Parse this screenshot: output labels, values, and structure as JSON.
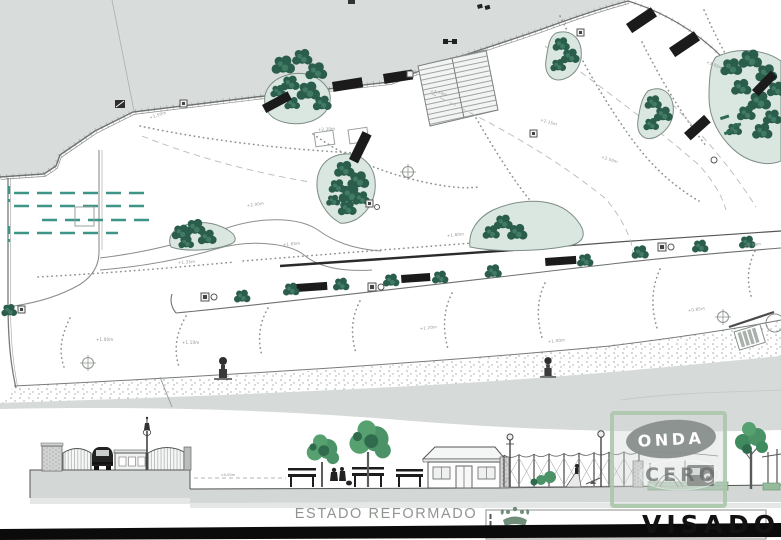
{
  "drawing": {
    "caption": "ESTADO REFORMADO",
    "stamp": {
      "title": "VISADO",
      "crest_icon": "crown-crest"
    },
    "watermark": {
      "line1": "ONDA",
      "line2": "CERO"
    },
    "section_label": "±0.00m",
    "spot_labels": [
      {
        "text": "+1.50m"
      },
      {
        "text": "+2.00m"
      },
      {
        "text": "+2.30m"
      },
      {
        "text": "+1.80m"
      },
      {
        "text": "+1.65m"
      },
      {
        "text": "+1.35m"
      },
      {
        "text": "+2.15m"
      },
      {
        "text": "+2.50m"
      },
      {
        "text": "+3.00m"
      },
      {
        "text": "+1.00m"
      },
      {
        "text": "+1.10m"
      },
      {
        "text": "+1.20m"
      },
      {
        "text": "+1.00m"
      },
      {
        "text": "+0.85m"
      },
      {
        "text": "+1.90m"
      },
      {
        "text": "+2.70m"
      }
    ],
    "colors": {
      "terrain_gray": "#d8dcda",
      "beach_gray": "#d6dad8",
      "planting_bed": "#d9e7e0",
      "tree_green": "#2a5d4c",
      "teal_dash": "#3f9488",
      "bench_black": "#1b1b1b",
      "elevation_green": "#4b9367",
      "watermark_border_green": "#abc7ab",
      "watermark_gray": "#878e8b",
      "stamp_ink": "#121212",
      "caption_gray": "#8f948f",
      "bottom_bar": "#0b0b0b"
    }
  }
}
